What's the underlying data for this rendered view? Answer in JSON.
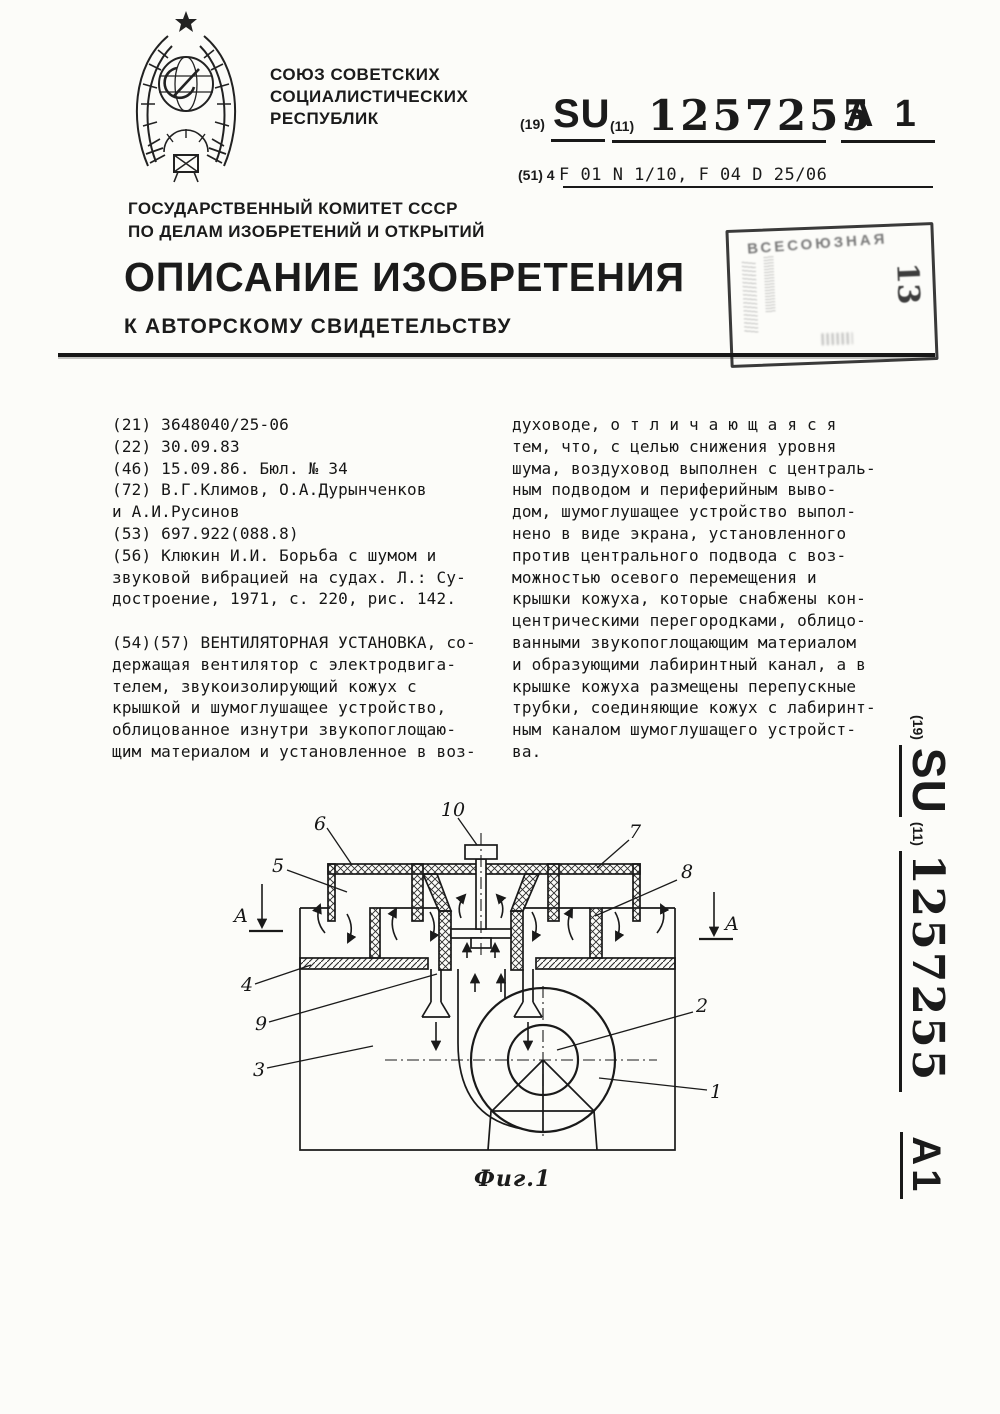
{
  "header": {
    "ussr_caption_lines": [
      "СОЮЗ СОВЕТСКИХ",
      "СОЦИАЛИСТИЧЕСКИХ",
      "РЕСПУБЛИК"
    ],
    "committee_lines": [
      "ГОСУДАРСТВЕННЫЙ КОМИТЕТ СССР",
      "ПО ДЕЛАМ ИЗОБРЕТЕНИЙ И ОТКРЫТИЙ"
    ],
    "code19_label": "(19)",
    "country_code": "SU",
    "code11_label": "(11)",
    "doc_number": "1257255",
    "kind_code": "A 1",
    "ipc_prefix": "(51) 4",
    "ipc_codes": "F 01 N 1/10, F 04 D 25/06",
    "title": "ОПИСАНИЕ ИЗОБРЕТЕНИЯ",
    "subtitle": "К АВТОРСКОМУ СВИДЕТЕЛЬСТВУ",
    "stamp": {
      "smudged_text": "ВСЕСОЮЗНАЯ",
      "number": "13"
    }
  },
  "body": {
    "left_column_lines": [
      "(21) 3648040/25-06",
      "(22) 30.09.83",
      "(46) 15.09.86. Бюл. № 34",
      "(72) В.Г.Климов, О.А.Дурынченков",
      "и А.И.Русинов",
      "(53) 697.922(088.8)",
      "(56) Клюкин И.И. Борьба с шумом и",
      "звуковой вибрацией на судах. Л.: Су-",
      "достроение, 1971, с. 220, рис. 142.",
      "",
      "(54)(57) ВЕНТИЛЯТОРНАЯ УСТАНОВКА, со-",
      "держащая вентилятор с электродвига-",
      "телем, звукоизолирующий кожух с",
      "крышкой и шумоглушащее устройство,",
      "облицованное изнутри звукопоглощаю-",
      "щим материалом и установленное в воз-"
    ],
    "right_column_lines": [
      "духоводе, о т л и ч а ю щ а я с я",
      "тем, что, с целью снижения уровня",
      "шума, воздуховод выполнен с централь-",
      "ным подводом и периферийным выво-",
      "дом, шумоглушащее устройство выпол-",
      "нено в виде экрана, установленного",
      "против центрального подвода с воз-",
      "можностью осевого перемещения и",
      "крышки кожуха, которые снабжены кон-",
      "центрическими перегородками, облицо-",
      "ванными звукопоглощающим материалом",
      "и образующими лабиринтный канал, а в",
      "крышке кожуха размещены перепускные",
      "трубки, соединяющие кожух с лабиринт-",
      "ным каналом шумоглушащего устройст-",
      "ва."
    ]
  },
  "sidebar": {
    "code19_label": "(19)",
    "country_code": "SU",
    "code11_label": "(11)",
    "doc_number": "1257255",
    "kind_code": "A1"
  },
  "figure": {
    "caption": "Фиг.1",
    "labels": {
      "n1": "1",
      "n2": "2",
      "n3": "3",
      "n4": "4",
      "n5": "5",
      "n6": "6",
      "n7": "7",
      "n8": "8",
      "n9": "9",
      "n10": "10",
      "section": "А"
    }
  }
}
